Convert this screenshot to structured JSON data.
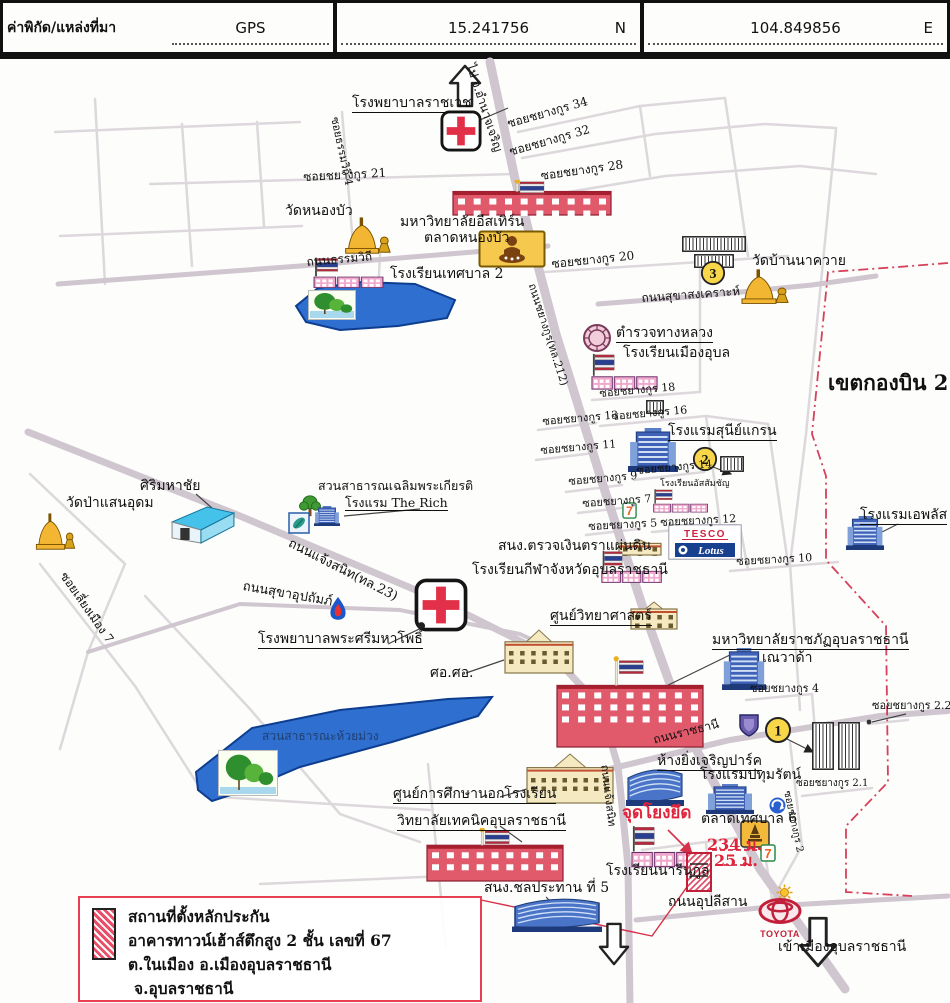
{
  "header": {
    "title": "ค่าพิกัด/แหล่งที่มา",
    "source": "GPS",
    "lat": "15.241756",
    "lat_dir": "N",
    "lon": "104.849856",
    "lon_dir": "E"
  },
  "legend": {
    "lines": [
      "สถานที่ตั้งหลักประกัน",
      "อาคารทาวน์เฮ้าส์ตึกสูง 2 ชั้น เลขที่ 67",
      "ต.ในเมือง อ.เมืองอุบลราชธานี",
      "จ.อุบลราชธานี"
    ]
  },
  "colors": {
    "accent_red": "#e0243c",
    "boundary": "#d6405a",
    "lake": "#2f6fd0",
    "road": "#d0c8d0"
  },
  "map": {
    "labels": [
      {
        "n": "hospital-ratchawet-label",
        "t": "โรงพยาบาลราชเวช",
        "x": 352,
        "y": 92,
        "fs": 14,
        "u": 1
      },
      {
        "n": "to-amnatcharoen-label",
        "t": "ไป จ.อำนาจเจริญ",
        "x": 476,
        "y": 58,
        "fs": 12,
        "rot": 72
      },
      {
        "n": "soi-chayangkun-34",
        "t": "ซอยชยางกูร 34",
        "x": 506,
        "y": 114,
        "fs": 12,
        "rot": -16
      },
      {
        "n": "soi-chayangkun-32",
        "t": "ซอยชยางกูร 32",
        "x": 508,
        "y": 142,
        "fs": 12,
        "rot": -16
      },
      {
        "n": "soi-chayangkun-28",
        "t": "ซอยชยางกูร 28",
        "x": 540,
        "y": 166,
        "fs": 12,
        "rot": -8
      },
      {
        "n": "soi-chayangkun-21",
        "t": "ซอยชยางกูร 21",
        "x": 303,
        "y": 167,
        "fs": 12,
        "rot": -3
      },
      {
        "n": "soi-thammawithi-4",
        "t": "ซอยธรรมวิถี 4",
        "x": 340,
        "y": 112,
        "fs": 11,
        "rot": 78
      },
      {
        "n": "wat-nongbua-label",
        "t": "วัดหนองบัว",
        "x": 285,
        "y": 200,
        "fs": 14
      },
      {
        "n": "eastern-university-label",
        "t": "มหาวิทยาลัยอีสเทิร์น",
        "x": 400,
        "y": 211,
        "fs": 14
      },
      {
        "n": "talat-nongbua-label",
        "t": "ตลาดหนองบัว",
        "x": 424,
        "y": 227,
        "fs": 14
      },
      {
        "n": "soi-chayangkun-20",
        "t": "ซอยชยางกูร 20",
        "x": 551,
        "y": 254,
        "fs": 12,
        "rot": -6
      },
      {
        "n": "thanon-thammawithi",
        "t": "ถนนธรรมวิถี",
        "x": 306,
        "y": 252,
        "fs": 12,
        "rot": -5
      },
      {
        "n": "school-tessaban2-label",
        "t": "โรงเรียนเทศบาล 2",
        "x": 390,
        "y": 263,
        "fs": 14
      },
      {
        "n": "wat-bannakhwai-label",
        "t": "วัดบ้านนาควาย",
        "x": 752,
        "y": 250,
        "fs": 14
      },
      {
        "n": "thanon-sukhasongkhro",
        "t": "ถนนสุขาสงเคราะห์",
        "x": 641,
        "y": 288,
        "fs": 12,
        "rot": -4
      },
      {
        "n": "khet-kongbin-21",
        "t": "เขตกองบิน 21",
        "x": 828,
        "y": 368,
        "fs": 21,
        "b": 1
      },
      {
        "n": "highway-police-label",
        "t": "ตำรวจทางหลวง",
        "x": 616,
        "y": 322,
        "fs": 14,
        "u": 1
      },
      {
        "n": "school-muang-ubon-label",
        "t": "โรงเรียนเมืองอุบล",
        "x": 623,
        "y": 342,
        "fs": 14
      },
      {
        "n": "soi-chayangkun-18",
        "t": "ซอยชยางกูร 18",
        "x": 599,
        "y": 384,
        "fs": 11,
        "rot": -5
      },
      {
        "n": "soi-chayangkun-16",
        "t": "ซอยชยางกูร 16",
        "x": 611,
        "y": 407,
        "fs": 11,
        "rot": -5
      },
      {
        "n": "soi-chayangkun-13",
        "t": "ซอยชยางกูร 13",
        "x": 542,
        "y": 412,
        "fs": 11,
        "rot": -5
      },
      {
        "n": "sunee-grand-hotel-label",
        "t": "โรงแรมสุนีย์แกรน",
        "x": 668,
        "y": 420,
        "fs": 14,
        "u": 1
      },
      {
        "n": "soi-chayangkun-11",
        "t": "ซอยชยางกูร 11",
        "x": 540,
        "y": 441,
        "fs": 11,
        "rot": -5
      },
      {
        "n": "soi-chayangkun-14",
        "t": "ซอยชยางกูร 14",
        "x": 636,
        "y": 461,
        "fs": 11,
        "rot": -5
      },
      {
        "n": "soi-chayangkun-9",
        "t": "ซอยชยางกูร 9",
        "x": 568,
        "y": 472,
        "fs": 11,
        "rot": -5
      },
      {
        "n": "assumption-school-label",
        "t": "โรงเรียนอัสสัมชัญ",
        "x": 660,
        "y": 476,
        "fs": 9
      },
      {
        "n": "soi-chayangkun-7",
        "t": "ซอยชยางกูร 7",
        "x": 582,
        "y": 494,
        "fs": 11,
        "rot": -4
      },
      {
        "n": "soi-chayangkun-5",
        "t": "ซอยชยางกูร 5",
        "x": 588,
        "y": 517,
        "fs": 11,
        "rot": -3
      },
      {
        "n": "soi-chayangkun-12",
        "t": "ซอยชยางกูร 12",
        "x": 660,
        "y": 513,
        "fs": 11,
        "rot": -3
      },
      {
        "n": "aplus-hotel-label",
        "t": "โรงแรมเอพลัส",
        "x": 860,
        "y": 504,
        "fs": 14,
        "u": 1
      },
      {
        "n": "soi-chayangkun-10",
        "t": "ซอยชยางกูร 10",
        "x": 736,
        "y": 552,
        "fs": 11,
        "rot": -3
      },
      {
        "n": "audit-office-label",
        "t": "สนง.ตรวจเงินตราแผ่นดิน",
        "x": 498,
        "y": 535,
        "fs": 14
      },
      {
        "n": "sports-school-label",
        "t": "โรงเรียนกีฬาจังหวัดอุบลราชธานี",
        "x": 472,
        "y": 559,
        "fs": 14
      },
      {
        "n": "sirimahachai-label",
        "t": "ศิริมหาชัย",
        "x": 140,
        "y": 475,
        "fs": 14
      },
      {
        "n": "wat-pa-saen-udom-label",
        "t": "วัดป่าแสนอุดม",
        "x": 66,
        "y": 492,
        "fs": 14
      },
      {
        "n": "park-chalermphrakiat-label",
        "t": "สวนสาธารณเฉลิมพระเกียรติ",
        "x": 318,
        "y": 475,
        "fs": 12.5
      },
      {
        "n": "the-rich-hotel-label",
        "t": "โรงแรม The Rich",
        "x": 345,
        "y": 492,
        "fs": 12.5,
        "u": 1
      },
      {
        "n": "thanon-chaengsanit",
        "t": "ถนนแจ้งสนิท(ทล.23)",
        "x": 292,
        "y": 533,
        "fs": 13,
        "rot": 27
      },
      {
        "n": "thanon-sukha-upatham",
        "t": "ถนนสุขาอุปถัมภ์",
        "x": 244,
        "y": 576,
        "fs": 13,
        "rot": 10
      },
      {
        "n": "soi-liang-muang-7",
        "t": "ซอยเลี่ยงเมือง 7",
        "x": 68,
        "y": 566,
        "fs": 12,
        "rot": 55
      },
      {
        "n": "phrasri-mahapho-hospital-label",
        "t": "โรงพยาบาลพระศรีมหาโพธิ์",
        "x": 258,
        "y": 628,
        "fs": 14,
        "u": 1
      },
      {
        "n": "science-center-label",
        "t": "ศูนย์วิทยาศาสตร์",
        "x": 550,
        "y": 605,
        "fs": 14,
        "u": 1
      },
      {
        "n": "sor-sor-label",
        "t": "ศอ.ศอ.",
        "x": 430,
        "y": 662,
        "fs": 14
      },
      {
        "n": "rajabhat-university-label",
        "t": "มหาวิทยาลัยราชภัฏอุบลราชธานี",
        "x": 712,
        "y": 629,
        "fs": 14,
        "u": 1
      },
      {
        "n": "nevada-label",
        "t": "เณวาด้า",
        "x": 762,
        "y": 647,
        "fs": 14
      },
      {
        "n": "soi-chayangkun-4",
        "t": "ซอยชยางกูร 4",
        "x": 750,
        "y": 679,
        "fs": 11
      },
      {
        "n": "soi-chayangkun-2-2",
        "t": "ซอยชยางกูร 2.2",
        "x": 872,
        "y": 696,
        "fs": 11
      },
      {
        "n": "thanon-ratchathani",
        "t": "ถนนราชธานี",
        "x": 652,
        "y": 730,
        "fs": 12,
        "rot": -14
      },
      {
        "n": "yingcharoen-park-label",
        "t": "ห้างยิ่งเจริญปาร์ค",
        "x": 657,
        "y": 750,
        "fs": 14,
        "u": 1
      },
      {
        "n": "pathumrat-hotel-label",
        "t": "โรงแรมปทุมรัตน์",
        "x": 700,
        "y": 764,
        "fs": 14
      },
      {
        "n": "soi-chayangkun-2-1",
        "t": "ซอยชยางกูร 2.1",
        "x": 796,
        "y": 775,
        "fs": 10
      },
      {
        "n": "soi-chayangkun-2",
        "t": "ซอยชยางกูร 2",
        "x": 791,
        "y": 786,
        "fs": 10,
        "rot": 78
      },
      {
        "n": "talat-tessaban-6-label",
        "t": "ตลาดเทศบาล 6",
        "x": 701,
        "y": 808,
        "fs": 14
      },
      {
        "n": "anchor-point-label",
        "t": "จุดโยงยึด",
        "x": 622,
        "y": 801,
        "fs": 17,
        "b": 1,
        "c": "#e0243c"
      },
      {
        "n": "narinukun-school-label",
        "t": "โรงเรียนนารีนุกูล",
        "x": 606,
        "y": 860,
        "fs": 14
      },
      {
        "n": "distance-234m",
        "t": "234 ม.",
        "x": 707,
        "y": 833,
        "fs": 16,
        "b": 1,
        "c": "#e0243c"
      },
      {
        "n": "distance-25m",
        "t": "25 ม.",
        "x": 714,
        "y": 849,
        "fs": 16,
        "b": 1,
        "c": "#e0243c"
      },
      {
        "n": "thanon-upalisan",
        "t": "ถนนอุปลีสาน",
        "x": 668,
        "y": 891,
        "fs": 14
      },
      {
        "n": "to-ubon-city-label",
        "t": "เข้าเมืองอุบลราชธานี",
        "x": 778,
        "y": 936,
        "fs": 14
      },
      {
        "n": "thanon-chaengsanit-south",
        "t": "ถนนแจ้งสนิท",
        "x": 610,
        "y": 760,
        "fs": 11,
        "rot": 83
      },
      {
        "n": "nfe-center-label",
        "t": "ศูนย์การศึกษานอกโรงเรียน",
        "x": 393,
        "y": 783,
        "fs": 14,
        "u": 1
      },
      {
        "n": "technical-college-label",
        "t": "วิทยาลัยเทคนิคอุบลราชธานี",
        "x": 397,
        "y": 810,
        "fs": 14,
        "u": 1
      },
      {
        "n": "irrigation-office-label",
        "t": "สนง.ชลประทาน ที่ 5",
        "x": 484,
        "y": 877,
        "fs": 14
      },
      {
        "n": "huai-muang-park-label",
        "t": "สวนสาธารณะห้วยม่วง",
        "x": 262,
        "y": 726,
        "fs": 12,
        "o": 0.5
      },
      {
        "n": "thanon-chayangkun-212",
        "t": "ถนนชยางกูร(ทล.212)",
        "x": 537,
        "y": 278,
        "fs": 11,
        "rot": 72
      }
    ],
    "icons": [
      {
        "t": "arrow-up",
        "n": "arrow-to-amnat",
        "x": 448,
        "y": 60,
        "w": 34,
        "h": 44
      },
      {
        "t": "red-cross",
        "n": "ratchawet-hospital-icon",
        "x": 440,
        "y": 106,
        "w": 42,
        "h": 42
      },
      {
        "t": "univ-red",
        "n": "eastern-university-building",
        "x": 452,
        "y": 176,
        "w": 160,
        "h": 36,
        "pole": 1
      },
      {
        "t": "temple",
        "n": "wat-nongbua-icon",
        "x": 336,
        "y": 212,
        "w": 58,
        "h": 42
      },
      {
        "t": "market-yellow",
        "n": "talat-nongbua-icon",
        "x": 478,
        "y": 226,
        "w": 68,
        "h": 38
      },
      {
        "t": "school-flag",
        "n": "tessaban2-school-icon",
        "x": 312,
        "y": 252,
        "w": 74,
        "h": 34
      },
      {
        "t": "lake-photo",
        "n": "lake1-photo",
        "x": 308,
        "y": 286,
        "w": 48,
        "h": 30
      },
      {
        "t": "hatch-building",
        "n": "hatch-buildings-3a",
        "x": 682,
        "y": 232,
        "w": 64,
        "h": 16
      },
      {
        "t": "hatch-building",
        "n": "hatch-buildings-3b",
        "x": 694,
        "y": 250,
        "w": 40,
        "h": 14
      },
      {
        "t": "badge",
        "n": "badge-3",
        "x": 700,
        "y": 256,
        "w": 26,
        "h": 26,
        "text": "3"
      },
      {
        "t": "temple",
        "n": "wat-bannakhwai-icon",
        "x": 732,
        "y": 264,
        "w": 60,
        "h": 40
      },
      {
        "t": "police-badge",
        "n": "highway-police-icon",
        "x": 582,
        "y": 318,
        "w": 30,
        "h": 34
      },
      {
        "t": "school-flag",
        "n": "muang-ubon-school-icon",
        "x": 590,
        "y": 348,
        "w": 70,
        "h": 40
      },
      {
        "t": "hatch-building",
        "n": "hatch-soi18",
        "x": 646,
        "y": 396,
        "w": 18,
        "h": 14
      },
      {
        "t": "hotel-blue",
        "n": "sunee-grand-hotel-icon",
        "x": 628,
        "y": 424,
        "w": 50,
        "h": 44
      },
      {
        "t": "badge",
        "n": "badge-2",
        "x": 692,
        "y": 442,
        "w": 26,
        "h": 26,
        "text": "2"
      },
      {
        "t": "hatch-building",
        "n": "hatch-badge2",
        "x": 720,
        "y": 452,
        "w": 24,
        "h": 16
      },
      {
        "t": "school-flag",
        "n": "assumption-school-icon",
        "x": 652,
        "y": 484,
        "w": 58,
        "h": 26
      },
      {
        "t": "seven",
        "n": "seven-eleven-icon-1",
        "x": 622,
        "y": 498,
        "w": 15,
        "h": 17,
        "text": "7"
      },
      {
        "t": "tesco-lotus",
        "n": "tesco-lotus-sign",
        "x": 668,
        "y": 520,
        "w": 74,
        "h": 36,
        "text1": "TESCO",
        "text2": "Lotus"
      },
      {
        "t": "hotel-blue",
        "n": "aplus-hotel-icon",
        "x": 846,
        "y": 512,
        "w": 38,
        "h": 34
      },
      {
        "t": "building-tan",
        "n": "audit-office-building",
        "x": 618,
        "y": 534,
        "w": 44,
        "h": 18
      },
      {
        "t": "school-flag",
        "n": "sports-school-icon",
        "x": 600,
        "y": 545,
        "w": 64,
        "h": 36
      },
      {
        "t": "warehouse-blue",
        "n": "sirimahachai-building",
        "x": 170,
        "y": 500,
        "w": 66,
        "h": 40
      },
      {
        "t": "temple",
        "n": "wat-pa-saen-udom-icon",
        "x": 28,
        "y": 508,
        "w": 50,
        "h": 42
      },
      {
        "t": "tree",
        "n": "park-tree-icon",
        "x": 298,
        "y": 490,
        "w": 24,
        "h": 24
      },
      {
        "t": "leaf-sign",
        "n": "park-leaf-sign",
        "x": 288,
        "y": 508,
        "w": 22,
        "h": 22
      },
      {
        "t": "hotel-blue",
        "n": "the-rich-hotel-icon",
        "x": 314,
        "y": 502,
        "w": 26,
        "h": 20
      },
      {
        "t": "ptt-flame",
        "n": "ptt-station-icon",
        "x": 327,
        "y": 592,
        "w": 22,
        "h": 26
      },
      {
        "t": "red-cross",
        "n": "phrasri-hospital-icon",
        "x": 414,
        "y": 574,
        "w": 54,
        "h": 54,
        "dot": 1
      },
      {
        "t": "building-tan",
        "n": "science-center-building",
        "x": 630,
        "y": 596,
        "w": 48,
        "h": 30
      },
      {
        "t": "building-tan",
        "n": "sor-sor-building",
        "x": 504,
        "y": 624,
        "w": 70,
        "h": 46
      },
      {
        "t": "univ-red",
        "n": "rajabhat-university-building",
        "x": 556,
        "y": 652,
        "w": 148,
        "h": 92,
        "pole": 1
      },
      {
        "t": "hotel-blue",
        "n": "nevada-building",
        "x": 722,
        "y": 644,
        "w": 44,
        "h": 42
      },
      {
        "t": "crest-sign",
        "n": "school-crest-sign",
        "x": 736,
        "y": 708,
        "w": 26,
        "h": 26
      },
      {
        "t": "badge",
        "n": "badge-1",
        "x": 764,
        "y": 712,
        "w": 28,
        "h": 28,
        "text": "1"
      },
      {
        "t": "hatch-building",
        "n": "collateral-area-buildings-a",
        "x": 812,
        "y": 718,
        "w": 22,
        "h": 48
      },
      {
        "t": "hatch-building",
        "n": "collateral-area-buildings-b",
        "x": 838,
        "y": 718,
        "w": 22,
        "h": 48
      },
      {
        "t": "mall-blue",
        "n": "yingcharoen-park-mall",
        "x": 626,
        "y": 758,
        "w": 58,
        "h": 44
      },
      {
        "t": "hotel-blue",
        "n": "pathumrat-hotel-icon",
        "x": 706,
        "y": 780,
        "w": 48,
        "h": 30
      },
      {
        "t": "roundabout-sign",
        "n": "roundabout-sign",
        "x": 768,
        "y": 792,
        "w": 19,
        "h": 19
      },
      {
        "t": "shrine-sign",
        "n": "city-shrine-sign",
        "x": 740,
        "y": 816,
        "w": 30,
        "h": 28
      },
      {
        "t": "school-flag",
        "n": "narinukun-school-icon",
        "x": 630,
        "y": 820,
        "w": 70,
        "h": 46
      },
      {
        "t": "collateral-red",
        "n": "collateral-building",
        "x": 686,
        "y": 848,
        "w": 26,
        "h": 40
      },
      {
        "t": "seven",
        "n": "seven-eleven-icon-2",
        "x": 760,
        "y": 840,
        "w": 16,
        "h": 18,
        "text": "7"
      },
      {
        "t": "sun-icon",
        "n": "sun-sign",
        "x": 776,
        "y": 880,
        "w": 17,
        "h": 17
      },
      {
        "t": "toyota",
        "n": "toyota-dealer-icon",
        "x": 756,
        "y": 894,
        "w": 48,
        "h": 42,
        "text": "TOYOTA"
      },
      {
        "t": "arrow-down",
        "n": "arrow-to-city",
        "x": 798,
        "y": 912,
        "w": 40,
        "h": 52
      },
      {
        "t": "arrow-down",
        "n": "arrow-road-south",
        "x": 598,
        "y": 918,
        "w": 32,
        "h": 44
      },
      {
        "t": "building-tan",
        "n": "nfe-center-building",
        "x": 526,
        "y": 748,
        "w": 88,
        "h": 52
      },
      {
        "t": "univ-red",
        "n": "technical-college-building",
        "x": 426,
        "y": 824,
        "w": 138,
        "h": 54,
        "pole": 1
      },
      {
        "t": "mall-blue",
        "n": "irrigation-office-building",
        "x": 512,
        "y": 888,
        "w": 90,
        "h": 40
      },
      {
        "t": "lake-photo",
        "n": "lake2-photo",
        "x": 218,
        "y": 746,
        "w": 60,
        "h": 46
      }
    ]
  }
}
